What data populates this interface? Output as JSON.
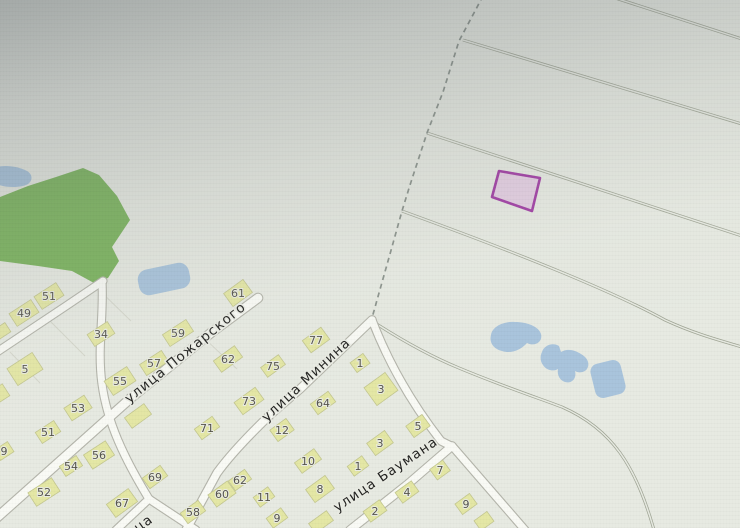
{
  "app": {
    "title": "map-viewer-photo"
  },
  "colors": {
    "bg": "#eaede4",
    "park": "#79b857",
    "water": "#a8c6e1",
    "roadFill": "#fcfdf8",
    "roadCasing": "#b5b6ab",
    "track": "#a1a795",
    "boundaryDash": "#8b948c",
    "house": "#e7eaa1",
    "houseStroke": "#c6ca8c",
    "houseNum": "#55544a",
    "streetText": "#1f1f1d",
    "halo": "#edefe6",
    "parcelStroke": "#a93aad",
    "parcelFill": "#e7cbe6",
    "plotLine": "#d7d9cd"
  },
  "map": {
    "streets": [
      {
        "text": "улица Пожарского",
        "x": 188,
        "y": 356,
        "r": -39
      },
      {
        "text": "улица Минина",
        "x": 309,
        "y": 383,
        "r": -43
      },
      {
        "text": "улица Баумана",
        "x": 388,
        "y": 478,
        "r": -34
      },
      {
        "text": "ца",
        "x": 146,
        "y": 527,
        "r": -36
      }
    ],
    "park": "0,197 28,186 56,177 83,168 99,175 117,196 130,220 112,247 119,261 108,278 94,283 72,271 38,266 0,261",
    "water_paths": [
      "M-10,170 C-2,164 16,165 27,171 C34,175 33,184 23,186 C8,189 -6,185 -10,179 Z",
      "M491,335 C492,327 503,321 515,322 C528,322 539,327 541,334 C543,342 535,347 527,343 C521,350 511,354 502,351 C493,349 489,342 491,335 Z",
      "M542,352 C544,345 553,342 559,346 L561,352 C567,348 575,350 581,354 C588,358 590,364 587,369 C584,373 578,373 575,371 C577,378 572,384 565,382 C559,380 557,374 558,369 C553,372 546,370 543,365 C540,361 540,356 542,352 Z"
    ],
    "water_rects": [
      {
        "cx": 164,
        "cy": 279,
        "w": 52,
        "h": 26,
        "r": -12,
        "rx": 10
      },
      {
        "cx": 608,
        "cy": 379,
        "w": 31,
        "h": 35,
        "r": -14,
        "rx": 8
      }
    ],
    "plot_lines": [
      "M95,286 L131,321",
      "M50,321 L85,356",
      "M10,352 L40,383",
      "M204,338 L237,369"
    ],
    "tracks": [
      "M612,-3 L742,39",
      "M463,40 L742,124",
      "M427,133 L742,236",
      "M402,211 C520,254 610,290 665,320 C695,334 722,341 742,347",
      "M372,321 C412,347 442,361 459,368 C502,386 541,399 562,407 C612,429 636,466 654,530"
    ],
    "boundary": "M483,-4 L459,41 L443,92 L427,133 L410,185 L402,211 L390,254 L379,293 L372,318",
    "roads": [
      {
        "d": "M-8,522 L48,472 L132,397 L212,332 L258,298",
        "w": 8.5
      },
      {
        "d": "M103,281 L66,306 L-6,354",
        "w": 7
      },
      {
        "d": "M102,282 C104,316 97,348 102,384 C107,422 124,458 149,499",
        "w": 7
      },
      {
        "d": "M149,499 L116,530",
        "w": 7
      },
      {
        "d": "M149,499 L196,530",
        "w": 7
      },
      {
        "d": "M372,320 L300,389 L271,414 C248,436 230,455 217,473 L186,530",
        "w": 7.5
      },
      {
        "d": "M372,320 C392,372 420,414 441,441 L453,447 L525,530",
        "w": 7
      },
      {
        "d": "M452,446 L408,484 L350,530",
        "w": 7.5
      }
    ],
    "parcel": {
      "points": "499,171 540,178 532,211 492,197"
    },
    "houses": [
      {
        "n": "51",
        "x": 49,
        "y": 296,
        "w": 26,
        "h": 15,
        "r": -33
      },
      {
        "n": "49",
        "x": 24,
        "y": 313,
        "w": 26,
        "h": 15,
        "r": -33
      },
      {
        "n": "",
        "x": 2,
        "y": 331,
        "w": 14,
        "h": 11,
        "r": -33
      },
      {
        "n": "5",
        "x": 25,
        "y": 369,
        "w": 30,
        "h": 20,
        "r": -33
      },
      {
        "n": "",
        "x": 1,
        "y": 393,
        "w": 12,
        "h": 14,
        "r": -33
      },
      {
        "n": "34",
        "x": 101,
        "y": 334,
        "w": 24,
        "h": 14,
        "r": -33
      },
      {
        "n": "55",
        "x": 120,
        "y": 381,
        "w": 27,
        "h": 17,
        "r": -33
      },
      {
        "n": "57",
        "x": 154,
        "y": 363,
        "w": 26,
        "h": 13,
        "r": -33
      },
      {
        "n": "59",
        "x": 178,
        "y": 333,
        "w": 28,
        "h": 14,
        "r": -33
      },
      {
        "n": "61",
        "x": 238,
        "y": 293,
        "w": 24,
        "h": 16,
        "r": -36
      },
      {
        "n": "62",
        "x": 228,
        "y": 359,
        "w": 26,
        "h": 14,
        "r": -36
      },
      {
        "n": "75",
        "x": 273,
        "y": 366,
        "w": 22,
        "h": 12,
        "r": -36
      },
      {
        "n": "73",
        "x": 249,
        "y": 401,
        "w": 26,
        "h": 15,
        "r": -36
      },
      {
        "n": "77",
        "x": 316,
        "y": 340,
        "w": 23,
        "h": 15,
        "r": -36
      },
      {
        "n": "53",
        "x": 78,
        "y": 408,
        "w": 24,
        "h": 15,
        "r": -33
      },
      {
        "n": "51",
        "x": 48,
        "y": 432,
        "w": 22,
        "h": 13,
        "r": -33
      },
      {
        "n": "9",
        "x": 4,
        "y": 451,
        "w": 16,
        "h": 12,
        "r": -33
      },
      {
        "n": "56",
        "x": 99,
        "y": 455,
        "w": 26,
        "h": 17,
        "r": -33
      },
      {
        "n": "54",
        "x": 71,
        "y": 466,
        "w": 20,
        "h": 12,
        "r": -33
      },
      {
        "n": "52",
        "x": 44,
        "y": 492,
        "w": 28,
        "h": 16,
        "r": -33
      },
      {
        "n": "",
        "x": 138,
        "y": 416,
        "w": 24,
        "h": 13,
        "r": -36
      },
      {
        "n": "71",
        "x": 207,
        "y": 428,
        "w": 22,
        "h": 13,
        "r": -36
      },
      {
        "n": "69",
        "x": 155,
        "y": 477,
        "w": 22,
        "h": 13,
        "r": -36
      },
      {
        "n": "67",
        "x": 122,
        "y": 503,
        "w": 27,
        "h": 16,
        "r": -36
      },
      {
        "n": "58",
        "x": 193,
        "y": 512,
        "w": 22,
        "h": 13,
        "r": -36
      },
      {
        "n": "60",
        "x": 222,
        "y": 494,
        "w": 24,
        "h": 15,
        "r": -36
      },
      {
        "n": "62",
        "x": 240,
        "y": 480,
        "w": 20,
        "h": 12,
        "r": -36
      },
      {
        "n": "11",
        "x": 264,
        "y": 497,
        "w": 18,
        "h": 12,
        "r": -36
      },
      {
        "n": "9",
        "x": 277,
        "y": 518,
        "w": 18,
        "h": 12,
        "r": -36
      },
      {
        "n": "8",
        "x": 320,
        "y": 489,
        "w": 24,
        "h": 16,
        "r": -36
      },
      {
        "n": "10",
        "x": 308,
        "y": 461,
        "w": 24,
        "h": 13,
        "r": -36
      },
      {
        "n": "12",
        "x": 282,
        "y": 430,
        "w": 20,
        "h": 14,
        "r": -36
      },
      {
        "n": "64",
        "x": 323,
        "y": 403,
        "w": 22,
        "h": 13,
        "r": -36
      },
      {
        "n": "1",
        "x": 360,
        "y": 363,
        "w": 16,
        "h": 12,
        "r": -36
      },
      {
        "n": "3",
        "x": 381,
        "y": 389,
        "w": 26,
        "h": 22,
        "r": -36
      },
      {
        "n": "5",
        "x": 418,
        "y": 426,
        "w": 20,
        "h": 14,
        "r": -36
      },
      {
        "n": "3",
        "x": 380,
        "y": 443,
        "w": 22,
        "h": 15,
        "r": -36
      },
      {
        "n": "1",
        "x": 358,
        "y": 466,
        "w": 18,
        "h": 12,
        "r": -36
      },
      {
        "n": "7",
        "x": 440,
        "y": 470,
        "w": 16,
        "h": 13,
        "r": -36
      },
      {
        "n": "4",
        "x": 407,
        "y": 492,
        "w": 20,
        "h": 13,
        "r": -36
      },
      {
        "n": "2",
        "x": 375,
        "y": 511,
        "w": 20,
        "h": 13,
        "r": -36
      },
      {
        "n": "9",
        "x": 466,
        "y": 504,
        "w": 18,
        "h": 13,
        "r": -36
      },
      {
        "n": "",
        "x": 484,
        "y": 521,
        "w": 16,
        "h": 12,
        "r": -36
      },
      {
        "n": "",
        "x": 321,
        "y": 522,
        "w": 22,
        "h": 12,
        "r": -36
      }
    ]
  }
}
